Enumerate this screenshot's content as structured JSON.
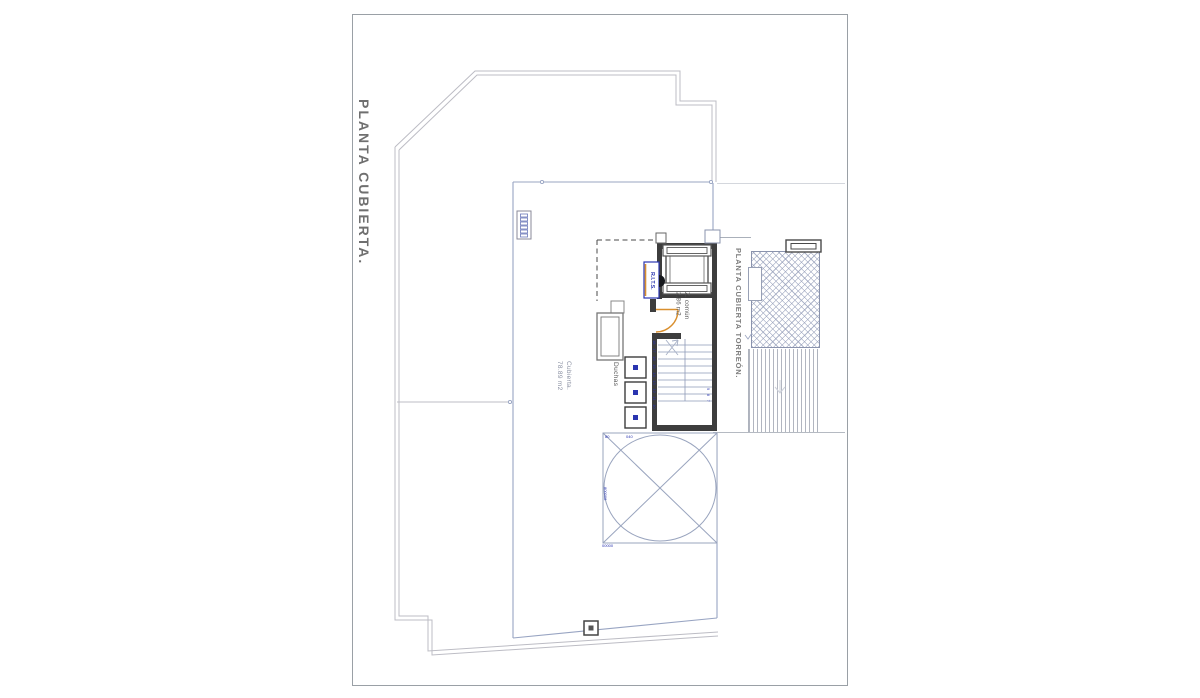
{
  "sheet": {
    "type": "architectural roof plan",
    "frame_color": "#9aa0a6",
    "background": "#ffffff"
  },
  "titles": {
    "main": "PLANTA CUBIERTA.",
    "torreon": "PLANTA CUBIERTA TORREÓN."
  },
  "areas": {
    "roof": {
      "name": "Cubierta.",
      "size": "78.89 m2"
    },
    "common": {
      "name": "Z. común",
      "size": "2.86 m2"
    }
  },
  "labels": {
    "showers": "Duchas",
    "telecom_box": "R.I.T.S."
  },
  "stairs": {
    "left_numbers": "18 17 16 15 14 13 12 11 10",
    "right_numbers": "9 8 7"
  },
  "skylight_markings": {
    "top_left": "80",
    "top_center": "040",
    "left_side": "800008",
    "bottom": "00000"
  },
  "colors": {
    "outline": "#bcbcc4",
    "roof_line": "#98a4c2",
    "wall": "#3d3d3d",
    "stair_line": "#8e9ab8",
    "accent_orange": "#d98f2e",
    "accent_blue": "#2a35b0",
    "title_gray": "#6f6f6f",
    "hatch": "#949eb9"
  }
}
